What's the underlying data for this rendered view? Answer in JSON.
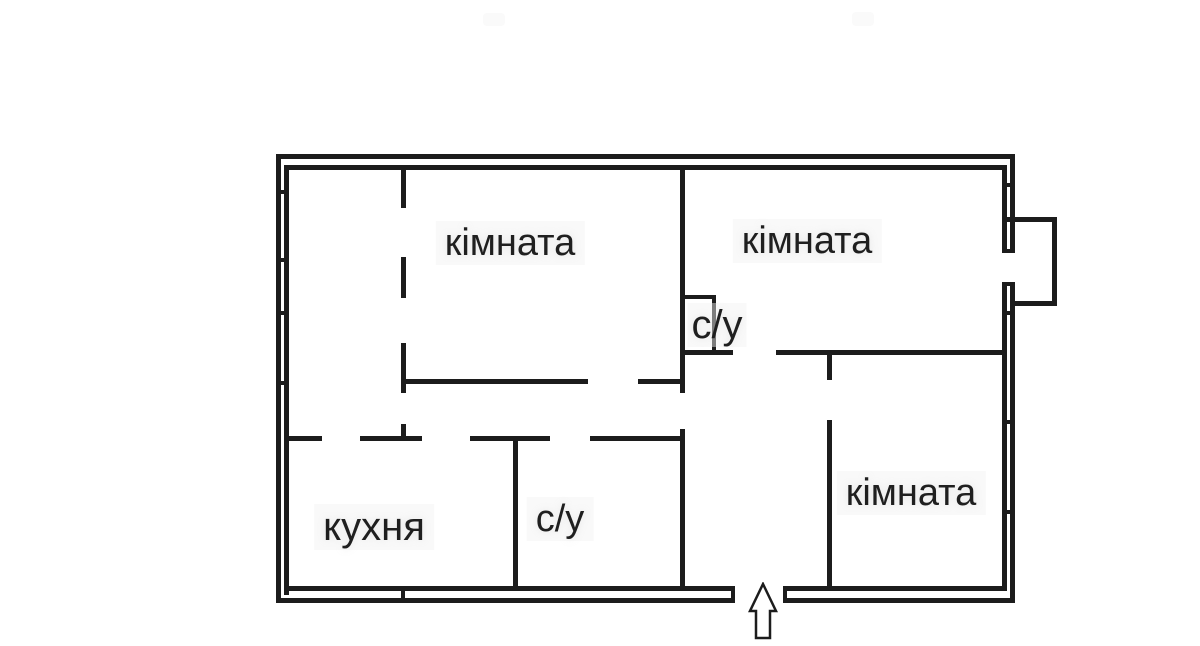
{
  "title": "apartment floor plan",
  "colors": {
    "wall": "#1c1c1c",
    "background": "#ffffff",
    "label_text": "#1f1f1f"
  },
  "rooms": {
    "room_top_left": {
      "label": "кімната"
    },
    "room_top_right": {
      "label": "кімната"
    },
    "bathroom_top": {
      "label": "с/у"
    },
    "kitchen": {
      "label": "кухня"
    },
    "bathroom_bottom": {
      "label": "с/у"
    },
    "room_bottom_right": {
      "label": "кімната"
    }
  },
  "entrance": {
    "symbol": "up-arrow"
  }
}
